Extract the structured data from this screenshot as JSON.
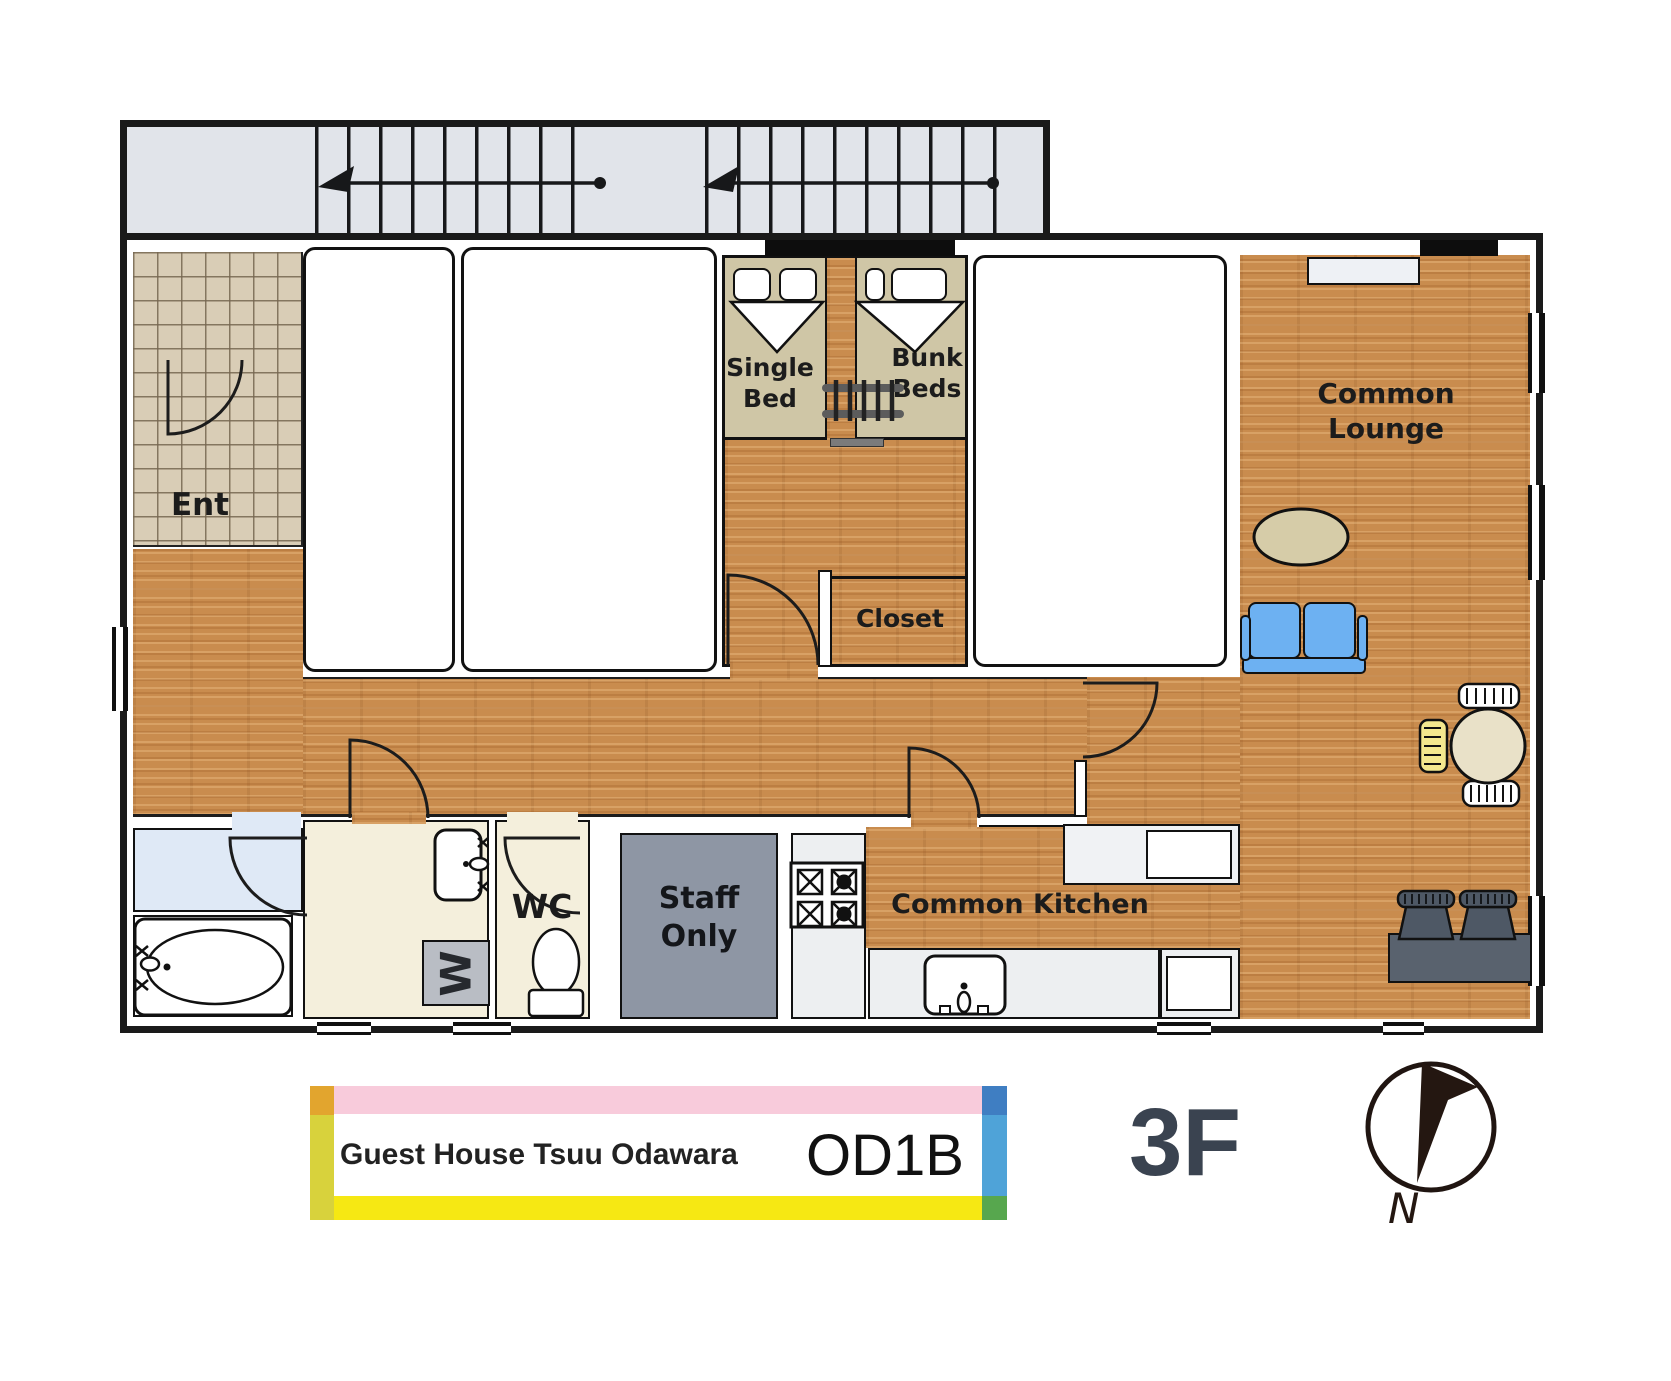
{
  "legend": {
    "building_name": "Guest House Tsuu Odawara",
    "unit_code": "OD1B",
    "floor": "3F",
    "compass_north": "N"
  },
  "rooms": {
    "entrance": {
      "label": "Ent"
    },
    "bunk_room": {
      "single_bed_line1": "Single",
      "single_bed_line2": "Bed",
      "bunk_beds_line1": "Bunk",
      "bunk_beds_line2": "Beds",
      "closet_label": "Closet"
    },
    "lounge": {
      "label": "Common Lounge"
    },
    "kitchen": {
      "label": "Common Kitchen"
    },
    "wc": {
      "label": "WC"
    },
    "staff_room": {
      "line1": "Staff",
      "line2": "Only"
    },
    "laundry": {
      "washer_label": "W"
    }
  },
  "colors": {
    "wood_floor": "#c98c4e",
    "tile_floor": "#d9cdb6",
    "stair_floor": "#e1e4ea",
    "bed_platform": "#cfc6a6",
    "staff_floor": "#8e96a4",
    "washroom_floor": "#f4efdc",
    "bathroom_floor": "#dfe9f6",
    "counter": "#edeff1",
    "sofa_blue": "#6db1f2",
    "rug_beige": "#d6cca8",
    "desk_gray": "#59626e",
    "plate_pink": "#f8cbdb",
    "plate_yellow": "#f6e813",
    "plate_blue": "#4fa3d8",
    "plate_green": "#57a74e",
    "plate_orange": "#e2a52e",
    "plate_olive": "#d8d23c",
    "floor_text": "#3a4350"
  }
}
